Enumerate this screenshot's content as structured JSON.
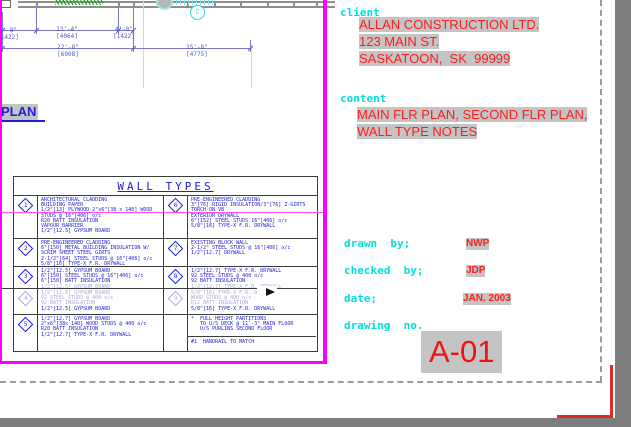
{
  "colors": {
    "viewport_border_magenta": "#ff00ff",
    "label_cyan": "#00dede",
    "entity_red": "#ff1c1c",
    "entity_blue": "#1d1dd6",
    "faded_blue": "#a9a9d9",
    "field_highlight_gray": "#c4c4c4",
    "paper_white": "#ffffff",
    "workspace_gray": "#7d7d7d"
  },
  "plan": {
    "label": "PLAN",
    "grid_bubble": "C",
    "dimensions": [
      {
        "imperial": "4'-8\"",
        "metric": "[1422]"
      },
      {
        "imperial": "13'-4\"",
        "metric": "[4064]"
      },
      {
        "imperial": "4'-8\"",
        "metric": "[1422]"
      },
      {
        "imperial": "22'-8\"",
        "metric": "[6908]"
      },
      {
        "imperial": "15'-8\"",
        "metric": "[4775]"
      }
    ]
  },
  "wall_types_table": {
    "title": "WALL TYPES",
    "rows": [
      {
        "left_marker": "1",
        "left_lines": [
          {
            "t": "ARCHITECTURAL CLADDING"
          },
          {
            "t": "BUILDING PAPER"
          },
          {
            "t": "1/2\"[13] PLYWOOD 2\"x6\"[38 x 140] WOOD"
          },
          {
            "t": "STUDS @ 16\"[406] o/c"
          },
          {
            "t": "R20 BATT INSULATION"
          },
          {
            "t": "VAPOUR BARRIER"
          },
          {
            "t": "1/2\"[12.5] GYPSUM BOARD"
          }
        ],
        "right_marker": "6",
        "right_lines": [
          {
            "t": "PRE-ENGINEERED CLADDING"
          },
          {
            "t": "3\"[76] RIGID INSULATION/3\"[76] Z-GIRTS"
          },
          {
            "t": "TORCH-ON VB"
          },
          {
            "t": "EXTERIOR DRYWALL"
          },
          {
            "t": "6\"[152] STEEL STUDS 16\"[406] o/c"
          },
          {
            "t": "5/8\"[16] TYPE-X F.R. DRYWALL"
          }
        ]
      },
      {
        "left_marker": "2",
        "left_lines": [
          {
            "t": "PRE-ENGINEERED CLADDING"
          },
          {
            "t": "6\"[150] METAL BUILDING INSULATION W/"
          },
          {
            "t": "SCRIM SHEET STEEL GIRTS"
          },
          {
            "t": "2-1/2\"[64] STEEL STUDS @ 16\"[406] o/c"
          },
          {
            "t": "5/8\"[16] TYPE-X F.R. DRYWALL"
          }
        ],
        "right_marker": "7",
        "right_lines": [
          {
            "t": "EXISTING BLOCK WALL"
          },
          {
            "t": "2-1/2\" STEEL STUDS @ 16\"[406] o/c"
          },
          {
            "t": "1/2\"[12.7] DRYWALL"
          }
        ]
      },
      {
        "left_marker": "3",
        "left_lines": [
          {
            "t": "1/2\"[12.5] GYPSUM BOARD"
          },
          {
            "t": "6\"[150] STEEL STUDS @ 16\"[406] o/c"
          },
          {
            "t": "6\"[150] BATT INSULATION"
          },
          {
            "t": "1/2\"[12.5] GYPSUM BOARD",
            "f": 1
          }
        ],
        "right_marker": "8",
        "right_lines": [
          {
            "t": "1/2\"[12.7] TYPE-X F.R. DRYWALL"
          },
          {
            "t": "92 STEEL STUDS @ 400 o/c"
          },
          {
            "t": "92 BATT INSULATION"
          },
          {
            "t": "1/2\"[12.7] TYPE-X F.R. DRYWALL",
            "f": 1
          }
        ]
      },
      {
        "left_marker": "4",
        "left_lines": [
          {
            "t": "1/2\"[12.5] GYPSUM BOARD",
            "f": 1
          },
          {
            "t": "92 STEEL STUDS @ 400 o/c",
            "f": 1
          },
          {
            "t": "92 BATT INSULATION",
            "f": 1
          },
          {
            "t": "1/2\"[12.5] GYPSUM BOARD"
          }
        ],
        "right_marker": "9",
        "right_lines": [
          {
            "t": "5/8\"[16] TYPE-X F.R. DRYWALL",
            "f": 1
          },
          {
            "t": "WOOD STUDS @ 400 o/c",
            "f": 1
          },
          {
            "t": "R12 BATT INSULATION",
            "f": 1
          },
          {
            "t": "5/8\"[16] TYPE-X F.R. DRYWALL"
          }
        ]
      },
      {
        "left_marker": "5",
        "left_lines": [
          {
            "t": "1/2\"[12.7] GYPSUM BOARD"
          },
          {
            "t": "2\"x6\"[38x 140] WOOD STUDS @ 400 o/c"
          },
          {
            "t": "R20 BATT INSULATION"
          },
          {
            "t": "1/2\"[12.7] TYPE-X F.R. DRYWALL"
          }
        ],
        "right_marker": "",
        "right_lines": [
          {
            "t": "*  FULL HEIGHT PARTITIONS"
          },
          {
            "t": "   TO U/S DECK @ 11'-3\" MAIN FLOOR"
          },
          {
            "t": "   U/S PURLINS SECOND FLOOR"
          },
          {
            "hr": 1
          },
          {
            "t": "#1  HANDRAIL TO MATCH"
          }
        ]
      }
    ]
  },
  "title_block": {
    "client_label": "client",
    "client_name": "ALLAN CONSTRUCTION LTD.",
    "client_address1": "123 MAIN ST.",
    "client_address2": "SASKATOON,  SK  99999",
    "content_label": "content",
    "content_line1": "MAIN FLR PLAN, SECOND FLR PLAN,",
    "content_line2": "WALL TYPE NOTES",
    "drawn_by_label": "drawn  by;",
    "drawn_by": "NWP",
    "checked_by_label": "checked  by;",
    "checked_by": "JDP",
    "date_label": "date;",
    "date": "JAN. 2003",
    "drawing_no_label": "drawing  no.",
    "drawing_no": "A-01"
  }
}
